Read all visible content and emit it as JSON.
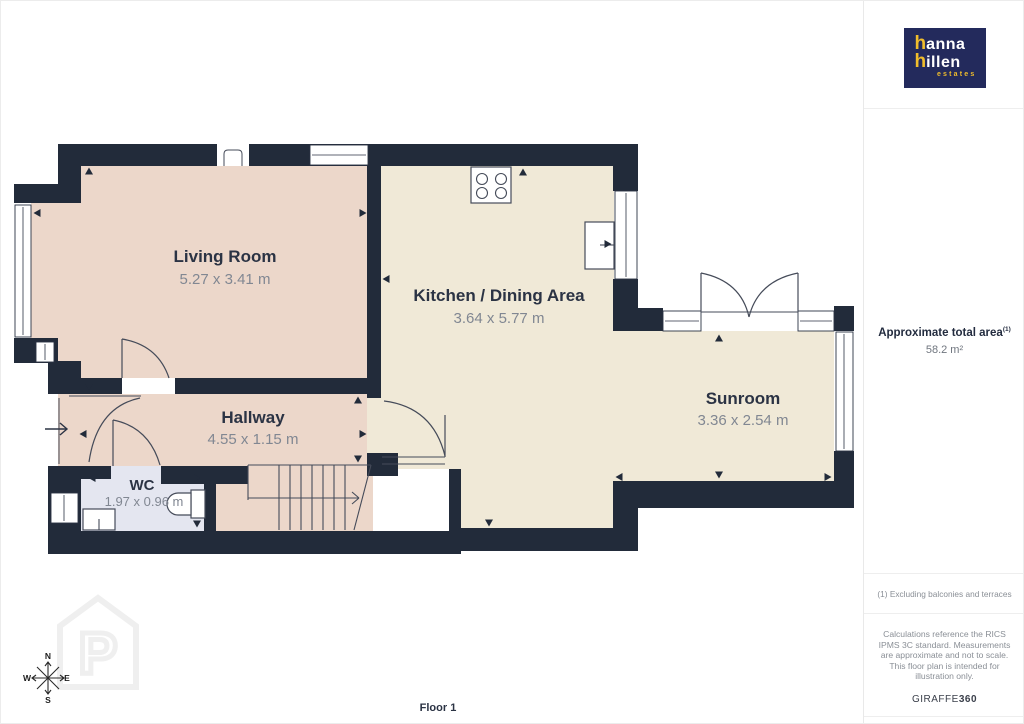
{
  "sidebar": {
    "logo": {
      "line1_initial": "h",
      "line1_rest": "anna",
      "line2_initial": "h",
      "line2_rest": "illen",
      "tagline": "estates"
    },
    "total_area_label": "Approximate total area",
    "total_area_note_ref": "(1)",
    "total_area_value": "58.2 m²",
    "footnote": "(1) Excluding balconies and terraces",
    "disclaimer": "Calculations reference the RICS IPMS 3C standard. Measurements are approximate and not to scale. This floor plan is intended for illustration only.",
    "provider": {
      "name": "GIRAFFE",
      "suffix": "360"
    }
  },
  "floor_plan": {
    "floor_label": "Floor 1",
    "compass": {
      "north": "N",
      "south": "S",
      "east": "E",
      "west": "W"
    },
    "rooms": [
      {
        "name": "Living Room",
        "dimensions": "5.27 x 3.41 m"
      },
      {
        "name": "Kitchen / Dining Area",
        "dimensions": "3.64 x 5.77 m"
      },
      {
        "name": "Hallway",
        "dimensions": "4.55 x 1.15 m"
      },
      {
        "name": "WC",
        "dimensions": "1.97 x 0.96 m"
      },
      {
        "name": "Sunroom",
        "dimensions": "3.36 x 2.54 m"
      }
    ],
    "colors": {
      "wall": "#222b3a",
      "living_hallway": "#ecd7ca",
      "kitchen_sunroom": "#f0e9d7",
      "wc": "#e4e6f0",
      "room_label": "#2b3344",
      "room_dims": "#818792",
      "logo_bg": "#232a5c",
      "logo_accent": "#f0bd2c"
    }
  }
}
